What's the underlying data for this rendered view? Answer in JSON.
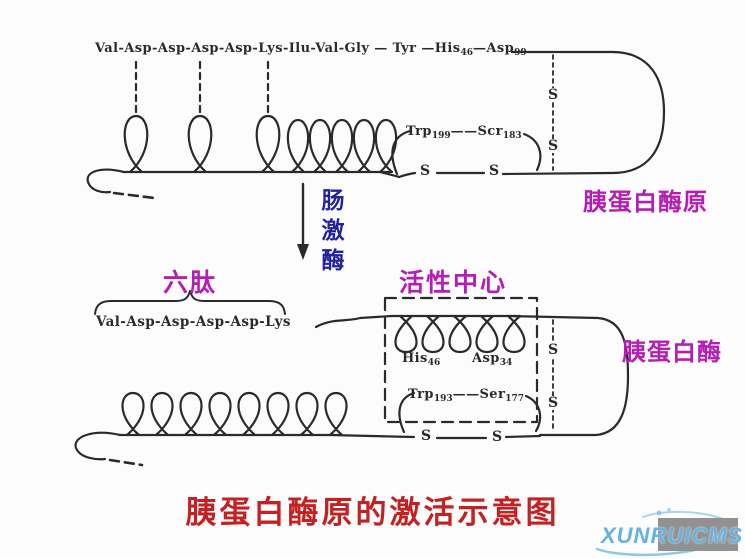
{
  "colors": {
    "ink": "#2a2a2a",
    "magenta": "#b41eb4",
    "enterokinase_blue": "#22229e",
    "title_red": "#c42222",
    "watermark_blue": "#6ab2dc",
    "watermark_gray": "#919191"
  },
  "top_chain": {
    "pre": "Val-Asp-Asp-Asp-Asp-Lys-Ilu-Val-Gly — Tyr —His",
    "his_sub": "46",
    "mid": "—Asp",
    "asp_sub": "99"
  },
  "top_loop": {
    "a": "Trp",
    "a_sub": "199",
    "dash": "——",
    "b": "Scr",
    "b_sub": "183"
  },
  "s_label": "S",
  "labels": {
    "trypsinogen": "胰蛋白酶原",
    "enterokinase": "肠激酶",
    "hexapeptide": "六肽",
    "active_center": "活性中心",
    "trypsin": "胰蛋白酶"
  },
  "bottom_chain": "Val-Asp-Asp-Asp-Asp-Lys",
  "active_site": {
    "his": "His",
    "his_sub": "46",
    "asp": "Asp",
    "asp_sub": "34",
    "trp": "Trp",
    "trp_sub": "193",
    "dash": "——",
    "ser": "Ser",
    "ser_sub": "177"
  },
  "title": "胰蛋白酶原的激活示意图",
  "watermark": "XUNRUICMS"
}
